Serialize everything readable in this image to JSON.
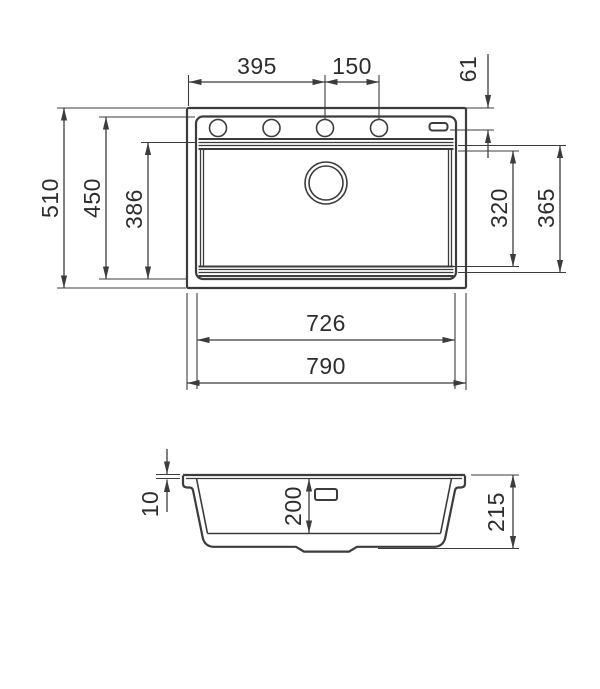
{
  "drawing": {
    "colors": {
      "line": "#3c3c3c",
      "text": "#2d2d2d",
      "background": "#ffffff"
    },
    "plan": {
      "tap_hole_offset": "395",
      "tap_hole_pitch": "150",
      "tap_hole_centerline_inset": "61",
      "overall_depth": "510",
      "rim_depth": "450",
      "bowl_ledge_depth": "386",
      "bowl_floor_depth": "320",
      "bowl_step_depth": "365",
      "bowl_width": "726",
      "overall_width": "790"
    },
    "section": {
      "rim_thickness": "10",
      "bowl_inner_depth": "200",
      "overall_height": "215"
    }
  }
}
